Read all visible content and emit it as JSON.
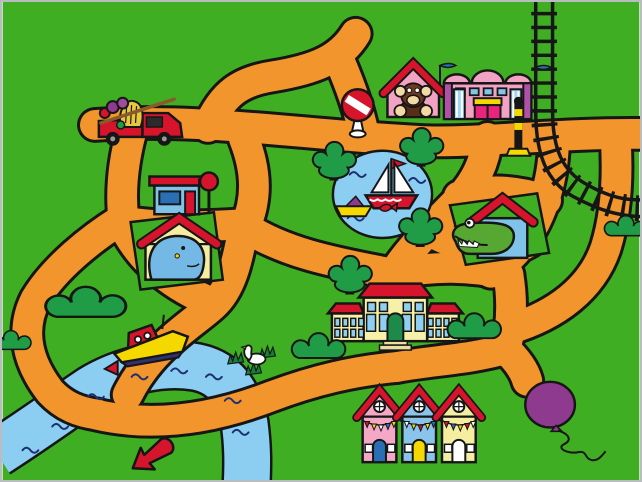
{
  "scene": {
    "type": "children-game-town-map",
    "title": "Toy Town Map",
    "canvas": {
      "width": 642,
      "height": 482
    },
    "frame_color": "#b9bdc0"
  },
  "palette": {
    "grass": "#3FAE22",
    "road": "#F2952D",
    "ink": "#161616",
    "water": "#8CCDF2",
    "wave": "#1C2F6E",
    "foliage": "#1F9C45",
    "tuft": "#14813A",
    "trunk": "#8A5A2A",
    "red": "#D6152C",
    "yellow": "#F5D800",
    "hay": "#E8C63F",
    "pale_yellow": "#F5EEA0",
    "cream": "#F7F0A8",
    "pink": "#F2A3C4",
    "house_pink": "#F4A8C6",
    "light_blue": "#85C4EA",
    "pale_blue": "#9FD4F2",
    "dark_blue": "#2A6FB3",
    "navy": "#2B2B2B",
    "keel": "#33306E",
    "purple": "#8E3A8E",
    "plum": "#A04AA0",
    "magenta": "#E8247C",
    "pilaster": "#B050A8",
    "croc_green": "#57A733",
    "hippo_blue": "#74B9E6",
    "monkey_brown": "#6B3A1F",
    "tan": "#F3D9A4",
    "door_green": "#1E8A4A",
    "interior_dark": "#5A2D16",
    "step": "#E8DFA0",
    "beak_orange": "#F09000",
    "white": "#FFFFFF"
  },
  "objects": [
    {
      "id": "fruit-truck",
      "label": "red truck loaded with hay and fruit",
      "x": 93,
      "y": 92,
      "w": 94,
      "h": 54,
      "clickable": true
    },
    {
      "id": "gas-station",
      "label": "filling station kiosk with round sign",
      "x": 146,
      "y": 168,
      "w": 74,
      "h": 50,
      "clickable": true
    },
    {
      "id": "hippo-house",
      "label": "hippo peeking from its house",
      "x": 128,
      "y": 210,
      "w": 96,
      "h": 82,
      "clickable": true
    },
    {
      "id": "monkey-house",
      "label": "monkey peeking from its house",
      "x": 386,
      "y": 60,
      "w": 58,
      "h": 58,
      "clickable": true
    },
    {
      "id": "theater",
      "label": "pink theater with blue flags",
      "x": 443,
      "y": 60,
      "w": 94,
      "h": 60,
      "clickable": true
    },
    {
      "id": "stop-sign",
      "label": "round striped stop sign",
      "x": 338,
      "y": 86,
      "w": 42,
      "h": 52,
      "clickable": true
    },
    {
      "id": "crossing-signal",
      "label": "railroad crossing signal",
      "x": 506,
      "y": 96,
      "w": 28,
      "h": 62,
      "clickable": true
    },
    {
      "id": "train-track",
      "label": "railway line curving to the right edge",
      "x": 522,
      "y": 0,
      "w": 124,
      "h": 224,
      "clickable": false
    },
    {
      "id": "pond",
      "label": "blue pond",
      "x": 332,
      "y": 149,
      "w": 104,
      "h": 92,
      "clickable": false
    },
    {
      "id": "sailboat",
      "label": "toy sailboat with red flag",
      "x": 362,
      "y": 150,
      "w": 60,
      "h": 60,
      "clickable": true
    },
    {
      "id": "toy-boat",
      "label": "yellow boat and jumping fish",
      "x": 334,
      "y": 192,
      "w": 64,
      "h": 28,
      "clickable": true
    },
    {
      "id": "crocodile-house",
      "label": "crocodile peeking from its house",
      "x": 449,
      "y": 190,
      "w": 104,
      "h": 78,
      "clickable": true
    },
    {
      "id": "mansion",
      "label": "yellow manor house with red roof",
      "x": 326,
      "y": 282,
      "w": 138,
      "h": 70,
      "clickable": true
    },
    {
      "id": "row-houses",
      "label": "three houses with bunting",
      "x": 356,
      "y": 380,
      "w": 128,
      "h": 86,
      "clickable": true
    },
    {
      "id": "motorboat",
      "label": "red and yellow motorboat on the river",
      "x": 102,
      "y": 314,
      "w": 92,
      "h": 58,
      "clickable": true
    },
    {
      "id": "water-flag",
      "label": "red flag in the river",
      "x": 98,
      "y": 360,
      "w": 20,
      "h": 20,
      "clickable": false
    },
    {
      "id": "swan",
      "label": "swan in the grass tufts",
      "x": 228,
      "y": 334,
      "w": 52,
      "h": 46,
      "clickable": true
    },
    {
      "id": "balloon",
      "label": "purple balloon with string",
      "x": 524,
      "y": 378,
      "w": 90,
      "h": 82,
      "clickable": true
    },
    {
      "id": "red-arrow",
      "label": "red arrow marker",
      "x": 124,
      "y": 428,
      "w": 60,
      "h": 54,
      "clickable": true
    },
    {
      "id": "river",
      "label": "winding river",
      "x": 0,
      "y": 316,
      "w": 262,
      "h": 166,
      "clickable": false
    },
    {
      "id": "tree-1",
      "label": "round tree left of pond",
      "x": 316,
      "y": 142,
      "w": 38,
      "h": 40,
      "clickable": false
    },
    {
      "id": "tree-2",
      "label": "round tree right of pond",
      "x": 404,
      "y": 128,
      "w": 38,
      "h": 40,
      "clickable": false
    },
    {
      "id": "tree-3",
      "label": "round tree below pond",
      "x": 403,
      "y": 209,
      "w": 38,
      "h": 40,
      "clickable": false
    },
    {
      "id": "tree-4",
      "label": "round tree beside mansion",
      "x": 332,
      "y": 257,
      "w": 38,
      "h": 40,
      "clickable": false
    },
    {
      "id": "bush-1",
      "label": "large bush near river",
      "x": 55,
      "y": 290,
      "w": 58,
      "h": 32,
      "clickable": false
    },
    {
      "id": "bush-2",
      "label": "bush west of mansion",
      "x": 300,
      "y": 340,
      "w": 38,
      "h": 22,
      "clickable": false
    },
    {
      "id": "bush-3",
      "label": "bush south of mansion",
      "x": 455,
      "y": 320,
      "w": 40,
      "h": 24,
      "clickable": false
    },
    {
      "id": "bush-4",
      "label": "bush at right edge",
      "x": 612,
      "y": 218,
      "w": 30,
      "h": 22,
      "clickable": false
    },
    {
      "id": "bush-5",
      "label": "bush at left edge",
      "x": 0,
      "y": 334,
      "w": 28,
      "h": 22,
      "clickable": false
    }
  ]
}
